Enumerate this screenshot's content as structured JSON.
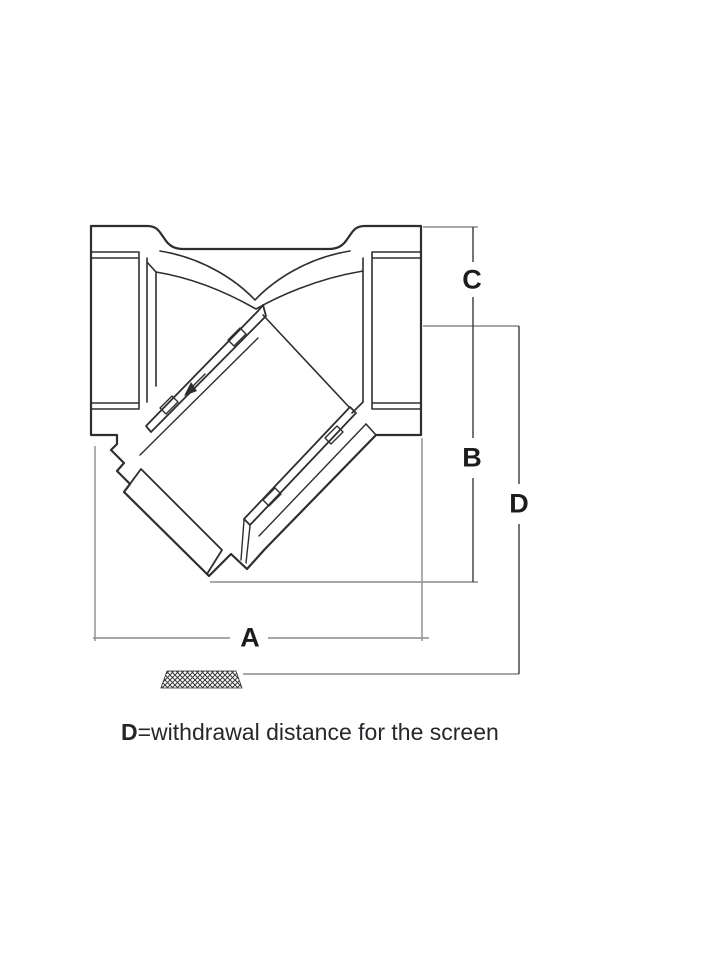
{
  "figure": {
    "dimension_labels": {
      "a": "A",
      "b": "B",
      "c": "C",
      "d": "D"
    },
    "caption": {
      "bold_term": "D",
      "rest": "=withdrawal distance for the screen"
    },
    "icons": {
      "hatch": "withdrawn-screen-mesh-hatch"
    },
    "theme": {
      "background": "#ffffff",
      "drawing_line": "#2e2e2e",
      "extension_line": "#8b8b8b",
      "dimension_line": "#3a3a3a",
      "label_text": "#1c1c1e",
      "caption_text": "#27272b"
    }
  }
}
